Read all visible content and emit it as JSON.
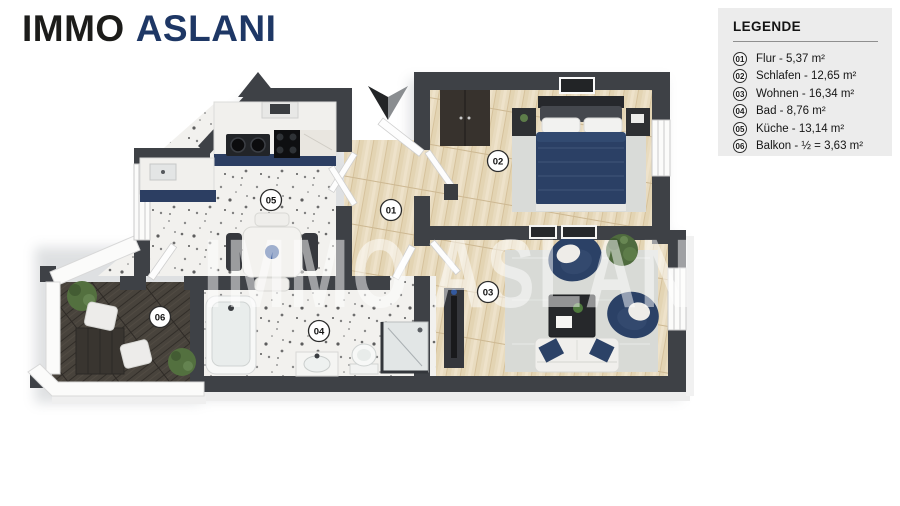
{
  "logo": {
    "part1": "IMMO",
    "part2": "ASLANI"
  },
  "legend": {
    "title": "LEGENDE",
    "items": [
      {
        "num": "01",
        "label": "Flur - 5,37 m²"
      },
      {
        "num": "02",
        "label": "Schlafen - 12,65 m²"
      },
      {
        "num": "03",
        "label": "Wohnen - 16,34 m²"
      },
      {
        "num": "04",
        "label": "Bad - 8,76 m²"
      },
      {
        "num": "05",
        "label": "Küche - 13,14 m²"
      },
      {
        "num": "06",
        "label": "Balkon - ½ = 3,63 m²"
      }
    ]
  },
  "plan": {
    "watermark": "IMMO ASLANI",
    "badges": [
      "01",
      "02",
      "03",
      "04",
      "05",
      "06"
    ]
  },
  "colors": {
    "wall": "#3e4146",
    "logo_accent": "#1e3765",
    "navy_furniture": "#2b4166",
    "wood_floor": "#e8dbbf",
    "terrazzo_floor": "#f2f1ee",
    "deck_floor": "#48433c",
    "rug": "#d8dad6",
    "legend_bg": "#ececec",
    "plant_green": "#53703f"
  }
}
